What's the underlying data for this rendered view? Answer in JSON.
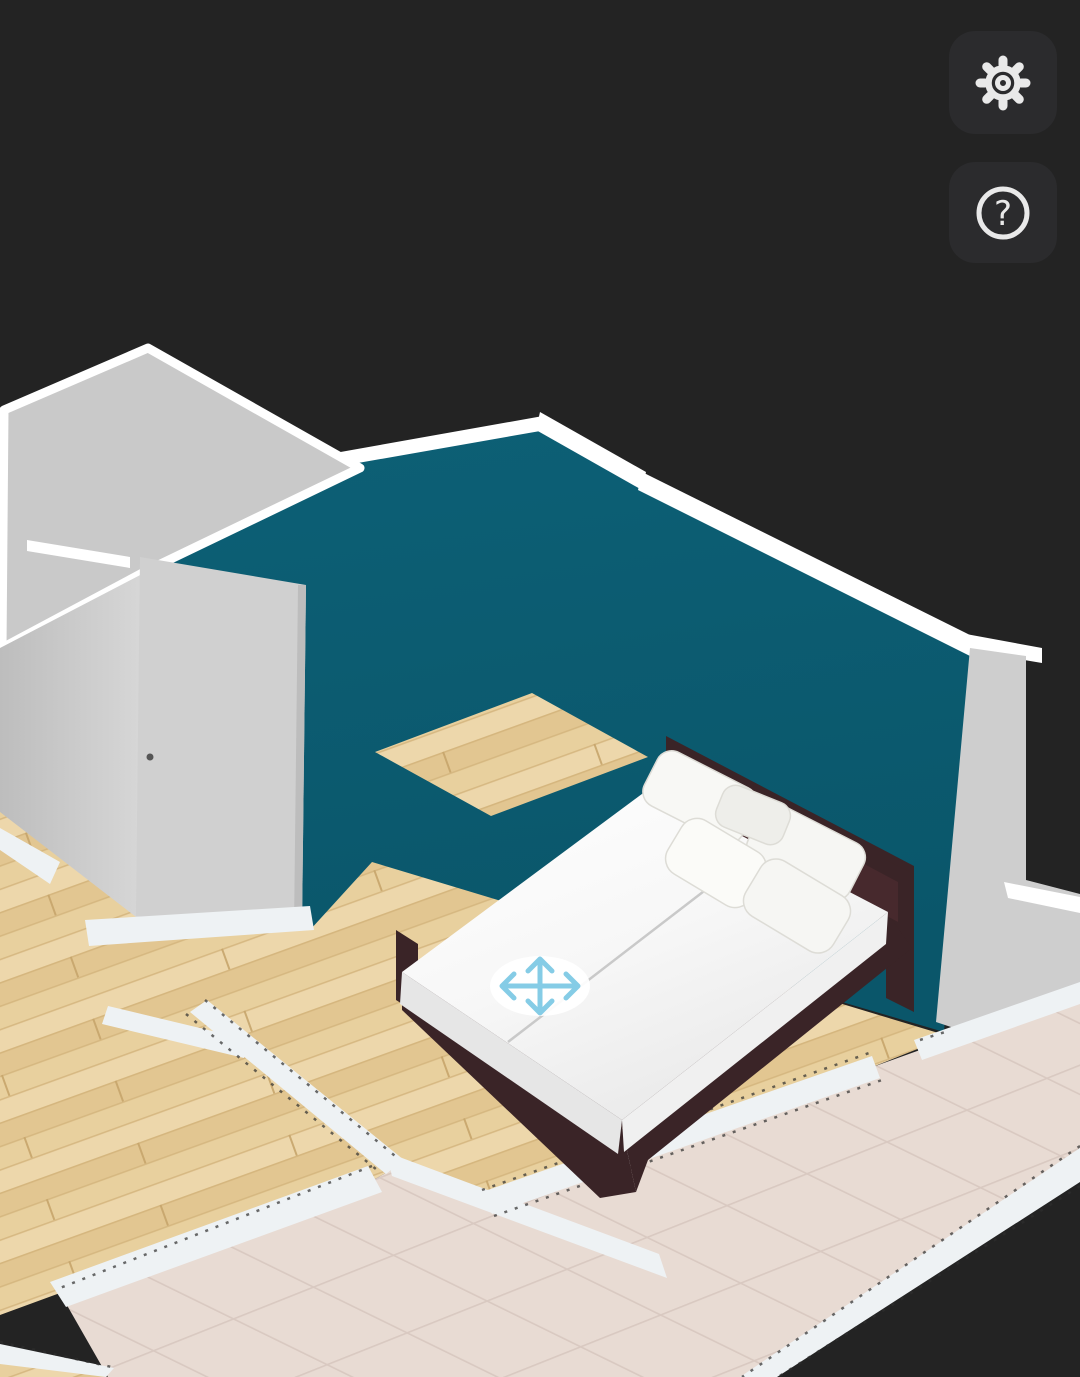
{
  "canvas": {
    "background": "#232323",
    "view": "3d-floor-plan-viewport"
  },
  "colors": {
    "background": "#232323",
    "button_bg": "#2b2b2d",
    "icon_color": "#e9e9e9",
    "wall_teal": "#0c5c72",
    "wall_trim_white": "#ffffff",
    "wall_gray_top": "#c9c9c9",
    "wall_gray_face": "#c6c6c6",
    "door_gray": "#cfcfcf",
    "wood_floor": "#e8d09e",
    "tile_floor": "#e8dbd3",
    "divider_white": "#eef2f4",
    "dash_color": "#2e2e2e",
    "bed_frame": "#3a2427",
    "bedding": "#fafafa",
    "pillow": "#f6f6f3",
    "handle_blue": "#85cce6"
  },
  "toolbar": {
    "buttons": [
      {
        "id": "settings",
        "icon": "gear-icon",
        "glyph": ""
      },
      {
        "id": "help",
        "icon": "question-mark-icon",
        "glyph": "?"
      }
    ]
  },
  "scene": {
    "rooms": [
      "bedroom-wood-floor",
      "hallway-wood-floor",
      "bathroom-tile-floor"
    ],
    "accent_wall_color": "#0c5c72",
    "furniture": [
      {
        "type": "double-bed",
        "frame": "dark-brown",
        "bedding": "white",
        "pillows": 5
      }
    ],
    "selection": {
      "tool": "move-furniture",
      "icon": "move-arrows-icon"
    }
  }
}
